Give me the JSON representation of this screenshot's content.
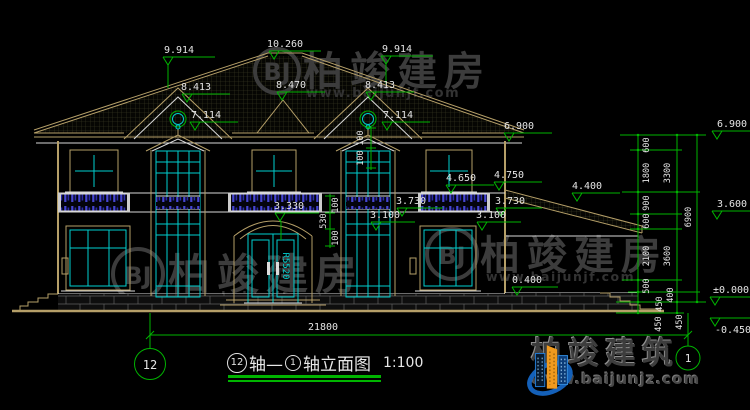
{
  "drawing": {
    "title": {
      "c1": "12",
      "t1": "轴—",
      "c2": "1",
      "t2": "轴立面图",
      "scale": "1:100"
    },
    "axis": {
      "left": "12",
      "right": "1"
    }
  },
  "flags": [
    {
      "label": "9.914"
    },
    {
      "label": "10.260"
    },
    {
      "label": "9.914"
    },
    {
      "label": "8.413"
    },
    {
      "label": "8.470"
    },
    {
      "label": "8.413"
    },
    {
      "label": "7.114"
    },
    {
      "label": "7.114"
    },
    {
      "label": "6.900"
    },
    {
      "label": "4.650"
    },
    {
      "label": "4.750"
    },
    {
      "label": "4.400"
    },
    {
      "label": "3.730"
    },
    {
      "label": "3.730"
    },
    {
      "label": "3.330"
    },
    {
      "label": "3.100"
    },
    {
      "label": "3.100"
    },
    {
      "label": "0.400"
    },
    {
      "label": "6.900"
    },
    {
      "label": "3.600"
    },
    {
      "label": "±0.000"
    },
    {
      "label": "-0.450"
    }
  ],
  "chain": {
    "inner": [
      "600",
      "1800",
      "900",
      "600",
      "2100",
      "500"
    ],
    "mid": [
      "3300",
      "3600"
    ],
    "total": "6900",
    "bottom": [
      "400",
      "450",
      "450",
      "450"
    ]
  },
  "dims": {
    "total": "21800",
    "door": [
      "100",
      "530",
      "100"
    ],
    "bay": [
      "100",
      "100"
    ]
  },
  "door": {
    "radius_label": "R5520"
  },
  "watermark": {
    "initials": "BJ",
    "name": "柏竣建房",
    "url": "www.baijunjf.com"
  },
  "brand": {
    "name": "柏竣建筑",
    "url": "www.baijunjz.com"
  },
  "colors": {
    "dim_green": "#00b400",
    "glass_cyan": "#00cfcf",
    "trim_tan": "#b59f68",
    "railing_blue": "#4646d2",
    "brand_blue": "#1460b8",
    "brand_orange": "#f09a1e",
    "text_white": "#e4e4e4",
    "watermark_gray": "#3c3c3c"
  }
}
